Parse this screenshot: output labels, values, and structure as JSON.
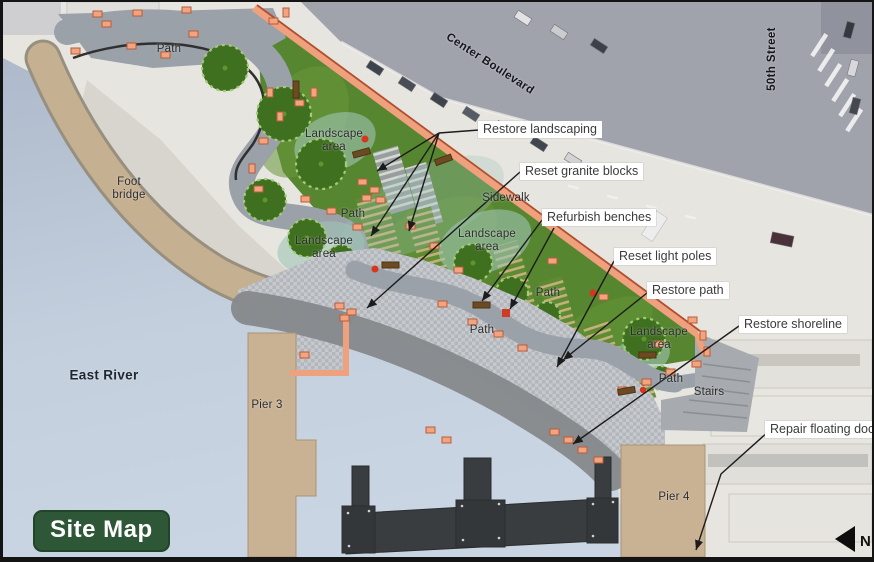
{
  "badge": {
    "label": "Site Map"
  },
  "compass": {
    "label": "N"
  },
  "water": {
    "label": "East River"
  },
  "streets": {
    "center_boulevard": "Center Boulevard",
    "fiftieth_street": "50th Street"
  },
  "features": {
    "path": "Path",
    "landscape_area": "Landscape area",
    "sidewalk": "Sidewalk",
    "foot_bridge": "Foot bridge",
    "pier_3": "Pier 3",
    "pier_4": "Pier 4",
    "stairs": "Stairs"
  },
  "annotations": [
    {
      "id": "restore-landscaping",
      "label": "Restore landscaping"
    },
    {
      "id": "reset-granite-blocks",
      "label": "Reset granite blocks"
    },
    {
      "id": "refurbish-benches",
      "label": "Refurbish benches"
    },
    {
      "id": "reset-light-poles",
      "label": "Reset light poles"
    },
    {
      "id": "restore-path",
      "label": "Restore path"
    },
    {
      "id": "restore-shoreline",
      "label": "Restore shoreline"
    },
    {
      "id": "repair-floating-dock",
      "label": "Repair floating dock"
    }
  ],
  "colors": {
    "badge_green": "#2d5737",
    "park_green": "#578631",
    "granite_salmon": "#f2a380",
    "boundary_red": "#b14e2e",
    "water_blue": "#bdc9d8",
    "pier_tan": "#c9b294",
    "dock_charcoal": "#3a3d40",
    "road_gray": "#a0a2ac"
  }
}
